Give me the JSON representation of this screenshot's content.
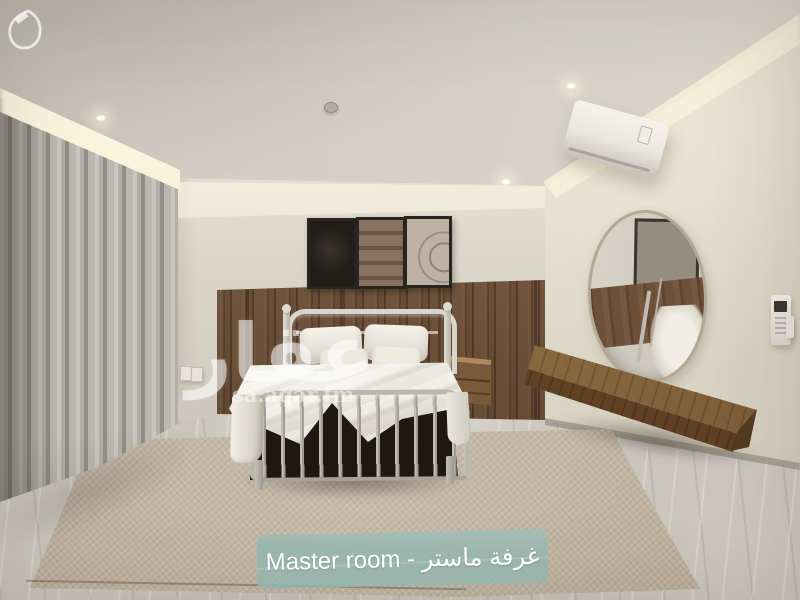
{
  "photo": {
    "caption": "Master room - غرفة ماستر",
    "watermark": {
      "arabic": "عقار",
      "site": "sa.aqar.fm",
      "logo_icon": "aqar-logo"
    },
    "colors": {
      "caption_bg": "#92b6af",
      "caption_text": "#ffffff",
      "ceiling": "#d3cfc6",
      "wall": "#d9d5c9",
      "wood_panel": "#6b4e37",
      "curtain": "#b2afa8",
      "bedding": "#ebe8e0",
      "rug": "#c2b5a2",
      "floor": "#c9c5bd",
      "shelf_wood": "#8c6c42",
      "metal_frame": "#bcb7ae"
    }
  }
}
